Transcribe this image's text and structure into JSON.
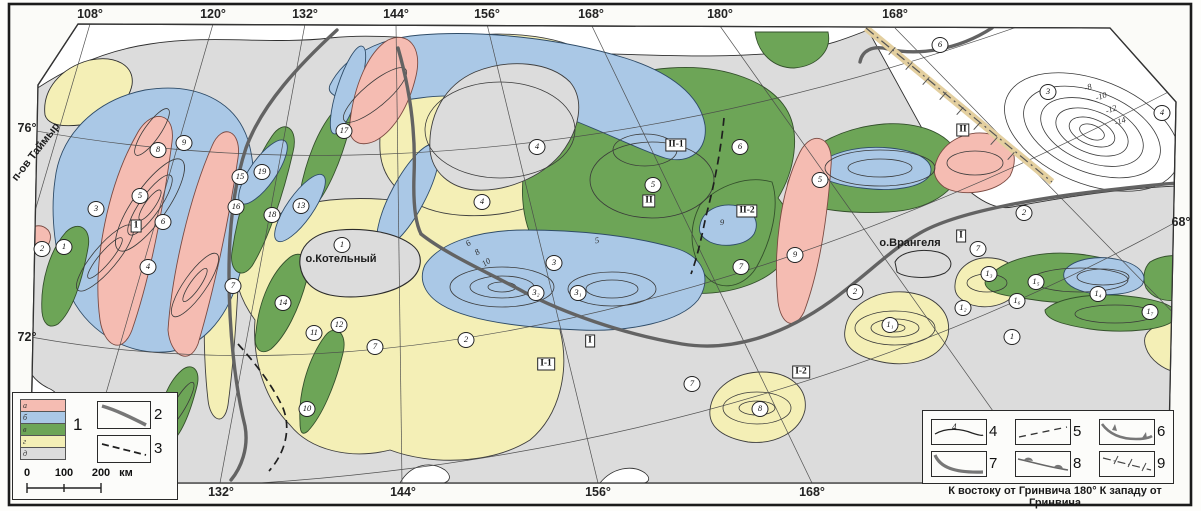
{
  "map": {
    "caption": "К востоку от Гринвича 180° К западу от Гринвича",
    "axis": {
      "top": [
        {
          "t": "108°",
          "x": 90
        },
        {
          "t": "120°",
          "x": 213
        },
        {
          "t": "132°",
          "x": 305
        },
        {
          "t": "144°",
          "x": 396
        },
        {
          "t": "156°",
          "x": 487
        },
        {
          "t": "168°",
          "x": 591
        },
        {
          "t": "180°",
          "x": 720
        },
        {
          "t": "168°",
          "x": 895
        }
      ],
      "bottom": [
        {
          "t": "132°",
          "x": 221
        },
        {
          "t": "144°",
          "x": 403
        },
        {
          "t": "156°",
          "x": 598
        },
        {
          "t": "168°",
          "x": 812
        }
      ],
      "left": [
        {
          "t": "76°",
          "y": 128
        },
        {
          "t": "72°",
          "y": 337
        }
      ],
      "right": [
        {
          "t": "68°",
          "y": 222
        }
      ]
    },
    "place_labels": [
      {
        "t": "о.Котельный",
        "x": 341,
        "y": 259,
        "r": 0
      },
      {
        "t": "о.Врангеля",
        "x": 910,
        "y": 243,
        "r": 0
      },
      {
        "t": "п-ов Таймыр",
        "x": 36,
        "y": 152,
        "r": -52
      }
    ],
    "region_boxes": [
      {
        "t": "1",
        "x": 136,
        "y": 226
      },
      {
        "t": "II-1",
        "x": 676,
        "y": 145
      },
      {
        "t": "II",
        "x": 649,
        "y": 201
      },
      {
        "t": "II-2",
        "x": 747,
        "y": 211
      },
      {
        "t": "II",
        "x": 963,
        "y": 130
      },
      {
        "t": "I",
        "x": 590,
        "y": 341
      },
      {
        "t": "I-1",
        "x": 546,
        "y": 364
      },
      {
        "t": "I-2",
        "x": 801,
        "y": 372
      },
      {
        "t": "I",
        "x": 961,
        "y": 236
      }
    ],
    "circled_numbers": [
      {
        "t": "1",
        "x": 64,
        "y": 247
      },
      {
        "t": "2",
        "x": 42,
        "y": 249
      },
      {
        "t": "3",
        "x": 96,
        "y": 209
      },
      {
        "t": "4",
        "x": 148,
        "y": 267
      },
      {
        "t": "5",
        "x": 140,
        "y": 196
      },
      {
        "t": "6",
        "x": 163,
        "y": 222
      },
      {
        "t": "7",
        "x": 233,
        "y": 286
      },
      {
        "t": "8",
        "x": 158,
        "y": 150
      },
      {
        "t": "9",
        "x": 184,
        "y": 143
      },
      {
        "t": "10",
        "x": 307,
        "y": 409
      },
      {
        "t": "11",
        "x": 314,
        "y": 333
      },
      {
        "t": "12",
        "x": 339,
        "y": 325
      },
      {
        "t": "13",
        "x": 301,
        "y": 206
      },
      {
        "t": "14",
        "x": 283,
        "y": 303
      },
      {
        "t": "15",
        "x": 240,
        "y": 177
      },
      {
        "t": "16",
        "x": 236,
        "y": 207
      },
      {
        "t": "17",
        "x": 344,
        "y": 131
      },
      {
        "t": "18",
        "x": 272,
        "y": 215
      },
      {
        "t": "19",
        "x": 262,
        "y": 172
      },
      {
        "t": "1",
        "x": 342,
        "y": 245
      },
      {
        "t": "7",
        "x": 375,
        "y": 347
      },
      {
        "t": "2",
        "x": 466,
        "y": 340
      },
      {
        "t": "4",
        "x": 537,
        "y": 147
      },
      {
        "t": "4",
        "x": 482,
        "y": 202
      },
      {
        "t": "3",
        "x": 554,
        "y": 263
      },
      {
        "t": "3₂",
        "x": 536,
        "y": 293
      },
      {
        "t": "3₁",
        "x": 578,
        "y": 293
      },
      {
        "t": "5",
        "x": 653,
        "y": 185
      },
      {
        "t": "6",
        "x": 740,
        "y": 147
      },
      {
        "t": "7",
        "x": 741,
        "y": 267
      },
      {
        "t": "9",
        "x": 795,
        "y": 255
      },
      {
        "t": "2",
        "x": 855,
        "y": 292
      },
      {
        "t": "5",
        "x": 820,
        "y": 180
      },
      {
        "t": "8",
        "x": 760,
        "y": 409
      },
      {
        "t": "7",
        "x": 692,
        "y": 384
      },
      {
        "t": "1₁",
        "x": 890,
        "y": 325
      },
      {
        "t": "6",
        "x": 940,
        "y": 45
      },
      {
        "t": "3",
        "x": 1048,
        "y": 92
      },
      {
        "t": "4",
        "x": 1162,
        "y": 113
      },
      {
        "t": "2",
        "x": 1024,
        "y": 213
      },
      {
        "t": "7",
        "x": 978,
        "y": 249
      },
      {
        "t": "1₃",
        "x": 989,
        "y": 274
      },
      {
        "t": "1₅",
        "x": 1036,
        "y": 282
      },
      {
        "t": "1₆",
        "x": 1017,
        "y": 301
      },
      {
        "t": "1₄",
        "x": 1098,
        "y": 294
      },
      {
        "t": "1₂",
        "x": 963,
        "y": 308
      },
      {
        "t": "1₇",
        "x": 1150,
        "y": 312
      },
      {
        "t": "1",
        "x": 1012,
        "y": 337
      }
    ],
    "contour_values": [
      {
        "t": "-8",
        "x": 1088,
        "y": 87,
        "r": -18
      },
      {
        "t": "-10",
        "x": 1101,
        "y": 96,
        "r": -18
      },
      {
        "t": "-12",
        "x": 1111,
        "y": 109,
        "r": -20
      },
      {
        "t": "-14",
        "x": 1120,
        "y": 121,
        "r": -20
      },
      {
        "t": "5",
        "x": 597,
        "y": 240,
        "r": -10
      },
      {
        "t": "6",
        "x": 468,
        "y": 243,
        "r": -35
      },
      {
        "t": "8",
        "x": 477,
        "y": 252,
        "r": -35
      },
      {
        "t": "10",
        "x": 486,
        "y": 262,
        "r": -35
      },
      {
        "t": "9",
        "x": 722,
        "y": 222,
        "r": 0
      }
    ]
  },
  "legend_left": {
    "group_label": "1",
    "swatches": [
      {
        "letter": "а",
        "color": "#f5bcb2"
      },
      {
        "letter": "б",
        "color": "#aac8e6"
      },
      {
        "letter": "в",
        "color": "#6da557"
      },
      {
        "letter": "г",
        "color": "#f4efb6"
      },
      {
        "letter": "д",
        "color": "#dcdcdc"
      }
    ],
    "items": [
      {
        "num": "2"
      },
      {
        "num": "3"
      }
    ],
    "scale": {
      "t0": "0",
      "t1": "100",
      "t2": "200",
      "unit": "км"
    }
  },
  "legend_right": {
    "items": [
      {
        "num": "4",
        "line_value": "4"
      },
      {
        "num": "5"
      },
      {
        "num": "6"
      },
      {
        "num": "7"
      },
      {
        "num": "8"
      },
      {
        "num": "9"
      }
    ]
  },
  "colors": {
    "pink": "#f5bcb2",
    "blue": "#aac8e6",
    "green": "#6da557",
    "yellow": "#f4efb6",
    "gray": "#dcdcdc",
    "thick_line": "#636363",
    "frame": "#333333"
  }
}
